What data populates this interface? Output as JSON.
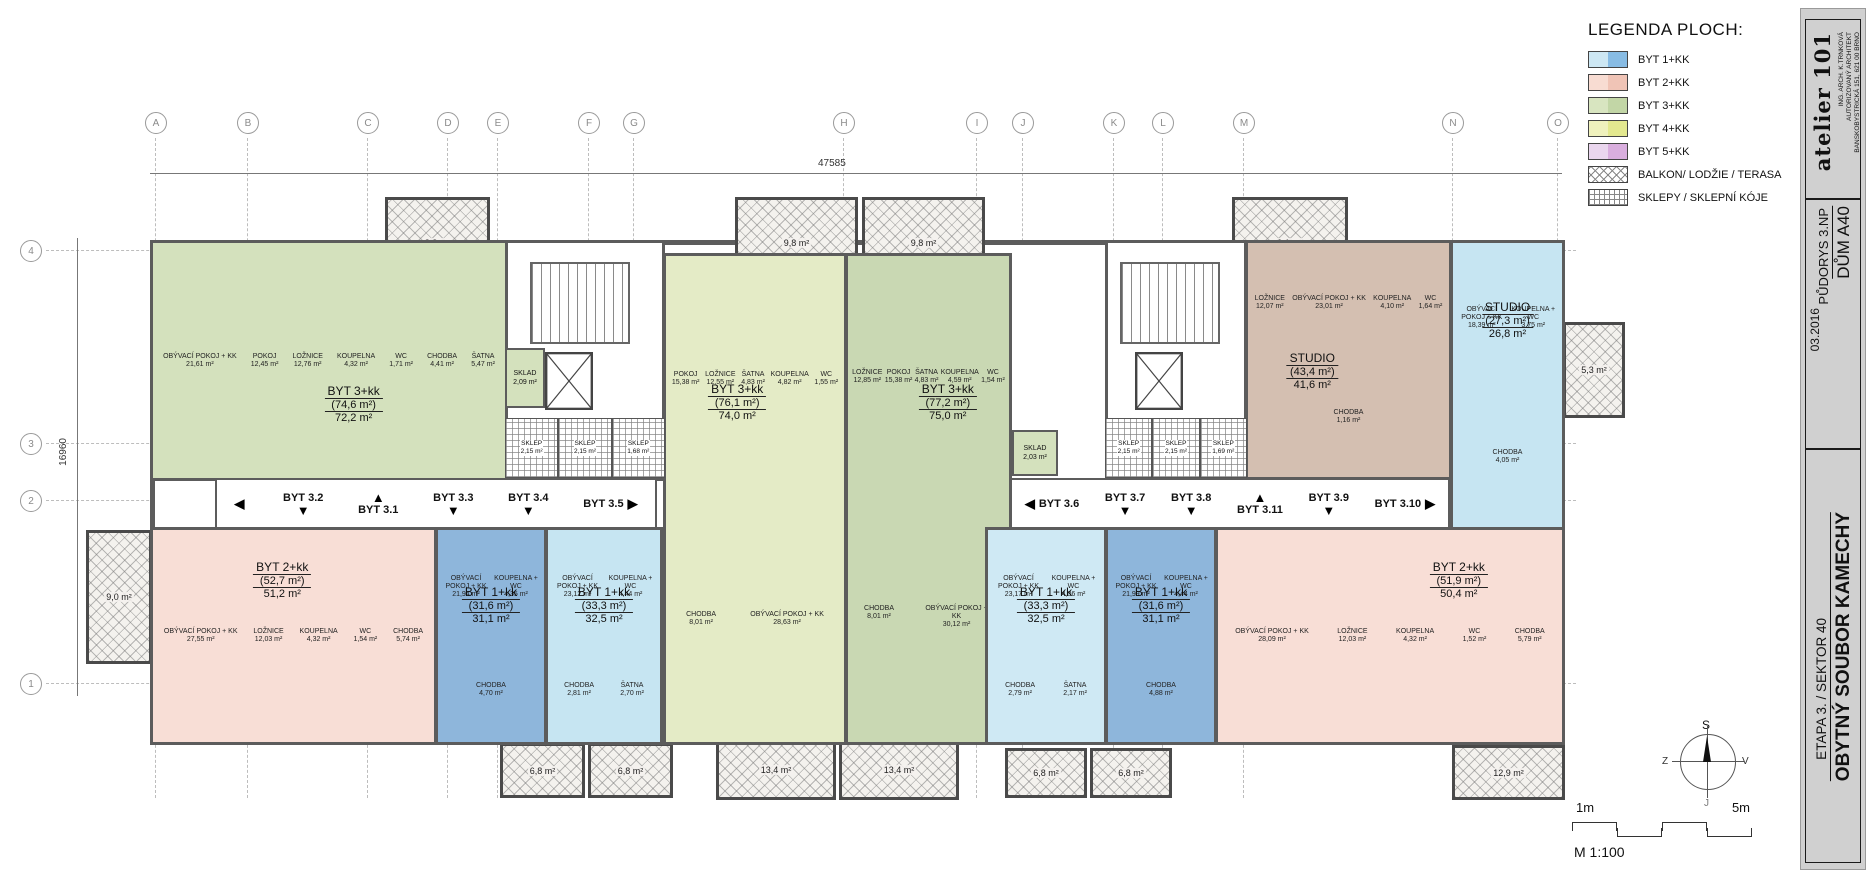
{
  "legend": {
    "title": "LEGENDA PLOCH:",
    "items": [
      {
        "label": "BYT 1+KK",
        "pattern": "duo",
        "c1": "#cde7f3",
        "c2": "#88bce4"
      },
      {
        "label": "BYT 2+KK",
        "pattern": "duo",
        "c1": "#f8dcd2",
        "c2": "#f0c4b6"
      },
      {
        "label": "BYT 3+KK",
        "pattern": "duo",
        "c1": "#d8e5c0",
        "c2": "#c2d6a6"
      },
      {
        "label": "BYT 4+KK",
        "pattern": "duo",
        "c1": "#eff1bd",
        "c2": "#e3e88f"
      },
      {
        "label": "BYT 5+KK",
        "pattern": "duo",
        "c1": "#ead6ee",
        "c2": "#d9aede"
      },
      {
        "label": "BALKON/ LODŽIE / TERASA",
        "pattern": "crosshatch"
      },
      {
        "label": "SKLEPY / SKLEPNÍ KÓJE",
        "pattern": "grid"
      }
    ]
  },
  "title_block": {
    "studio": "atelier 101",
    "architect": "ING. ARCH. K.TRNKOVÁ",
    "architect2": "AUTORIZOVANÝ ARCHITEKT",
    "address": "BANSKOBYSTRICKÁ 151, 621 00 BRNO",
    "building": "DŮM A40",
    "drawing": "PŮDORYS 3.NP",
    "date": "03.2016",
    "project": "OBYTNÝ SOUBOR KAMECHY",
    "stage": "ETAPA 3. / SEKTOR 40"
  },
  "grid": {
    "columns": [
      "A",
      "B",
      "C",
      "D",
      "E",
      "F",
      "G",
      "H",
      "I",
      "J",
      "K",
      "L",
      "M",
      "N",
      "O"
    ],
    "rows": [
      "4",
      "3",
      "2",
      "1"
    ],
    "dim_h": "47585",
    "dim_v": "16960"
  },
  "apartments": [
    {
      "type": "BYT 3+kk",
      "gross": "(74,6 m²)",
      "net": "72,2 m²",
      "fill": "#d4e1bd",
      "rooms": [
        {
          "name": "OBÝVACÍ POKOJ + KK",
          "area": "21,61 m²"
        },
        {
          "name": "POKOJ",
          "area": "12,45 m²"
        },
        {
          "name": "LOŽNICE",
          "area": "12,76 m²"
        },
        {
          "name": "KOUPELNA",
          "area": "4,32 m²"
        },
        {
          "name": "WC",
          "area": "1,71 m²"
        },
        {
          "name": "CHODBA",
          "area": "4,41 m²"
        },
        {
          "name": "ŠATNA",
          "area": "5,47 m²"
        }
      ]
    },
    {
      "type": "BYT 3+kk",
      "gross": "(76,1 m²)",
      "net": "74,0 m²",
      "fill": "#e4ebc6",
      "rooms": [
        {
          "name": "POKOJ",
          "area": "15,38 m²"
        },
        {
          "name": "LOŽNICE",
          "area": "12,55 m²"
        },
        {
          "name": "ŠATNA",
          "area": "4,83 m²"
        },
        {
          "name": "KOUPELNA",
          "area": "4,82 m²"
        },
        {
          "name": "WC",
          "area": "1,55 m²"
        },
        {
          "name": "CHODBA",
          "area": "8,01 m²"
        },
        {
          "name": "OBÝVACÍ POKOJ + KK",
          "area": "28,63 m²"
        }
      ]
    },
    {
      "type": "BYT 3+kk",
      "gross": "(77,2 m²)",
      "net": "75,0 m²",
      "fill": "#c9d8b3",
      "rooms": [
        {
          "name": "LOŽNICE",
          "area": "12,85 m²"
        },
        {
          "name": "POKOJ",
          "area": "15,38 m²"
        },
        {
          "name": "ŠATNA",
          "area": "4,83 m²"
        },
        {
          "name": "KOUPELNA",
          "area": "4,59 m²"
        },
        {
          "name": "WC",
          "area": "1,54 m²"
        },
        {
          "name": "CHODBA",
          "area": "8,01 m²"
        },
        {
          "name": "OBÝVACÍ POKOJ + KK",
          "area": "30,12 m²"
        }
      ]
    },
    {
      "type": "STUDIO",
      "gross": "(43,4 m²)",
      "net": "41,6 m²",
      "fill": "#d4bfb1",
      "rooms": [
        {
          "name": "LOŽNICE",
          "area": "12,07 m²"
        },
        {
          "name": "OBÝVACÍ POKOJ + KK",
          "area": "23,01 m²"
        },
        {
          "name": "KOUPELNA",
          "area": "4,10 m²"
        },
        {
          "name": "WC",
          "area": "1,64 m²"
        },
        {
          "name": "CHODBA",
          "area": "1,16 m²"
        }
      ]
    },
    {
      "type": "STUDIO",
      "gross": "(27,3 m²)",
      "net": "26,8 m²",
      "fill": "#c6e5f2",
      "rooms": [
        {
          "name": "OBÝVACÍ POKOJ + KK",
          "area": "18,39 m²"
        },
        {
          "name": "KOUPELNA + WC",
          "area": "3,75 m²"
        },
        {
          "name": "CHODBA",
          "area": "4,05 m²"
        }
      ]
    },
    {
      "type": "BYT 2+kk",
      "gross": "(52,7 m²)",
      "net": "51,2 m²",
      "fill": "#f8ded6",
      "rooms": [
        {
          "name": "OBÝVACÍ POKOJ + KK",
          "area": "27,55 m²"
        },
        {
          "name": "LOŽNICE",
          "area": "12,03 m²"
        },
        {
          "name": "KOUPELNA",
          "area": "4,32 m²"
        },
        {
          "name": "WC",
          "area": "1,54 m²"
        },
        {
          "name": "CHODBA",
          "area": "5,74 m²"
        }
      ]
    },
    {
      "type": "BYT 1+kk",
      "gross": "(31,6 m²)",
      "net": "31,1 m²",
      "fill": "#8eb6db",
      "rooms": [
        {
          "name": "OBÝVACÍ POKOJ + KK",
          "area": "21,94 m²"
        },
        {
          "name": "KOUPELNA + WC",
          "area": "4,35 m²"
        },
        {
          "name": "CHODBA",
          "area": "4,70 m²"
        }
      ]
    },
    {
      "type": "BYT 1+kk",
      "gross": "(33,3 m²)",
      "net": "32,5 m²",
      "fill": "#c6e5f2",
      "rooms": [
        {
          "name": "OBÝVACÍ POKOJ + KK",
          "area": "23,12 m²"
        },
        {
          "name": "KOUPELNA + WC",
          "area": "4,44 m²"
        },
        {
          "name": "CHODBA",
          "area": "2,81 m²"
        },
        {
          "name": "ŠATNA",
          "area": "2,70 m²"
        }
      ]
    },
    {
      "type": "BYT 1+kk",
      "gross": "(33,3 m²)",
      "net": "32,5 m²",
      "fill": "#cfe9f4",
      "rooms": [
        {
          "name": "OBÝVACÍ POKOJ + KK",
          "area": "23,17 m²"
        },
        {
          "name": "KOUPELNA + WC",
          "area": "4,36 m²"
        },
        {
          "name": "CHODBA",
          "area": "2,79 m²"
        },
        {
          "name": "ŠATNA",
          "area": "2,17 m²"
        }
      ]
    },
    {
      "type": "BYT 1+kk",
      "gross": "(31,6 m²)",
      "net": "31,1 m²",
      "fill": "#8eb6db",
      "rooms": [
        {
          "name": "OBÝVACÍ POKOJ + KK",
          "area": "21,99 m²"
        },
        {
          "name": "KOUPELNA + WC",
          "area": "4,44 m²"
        },
        {
          "name": "CHODBA",
          "area": "4,88 m²"
        }
      ]
    },
    {
      "type": "BYT 2+kk",
      "gross": "(51,9 m²)",
      "net": "50,4 m²",
      "fill": "#f8ded6",
      "rooms": [
        {
          "name": "OBÝVACÍ POKOJ + KK",
          "area": "28,09 m²"
        },
        {
          "name": "LOŽNICE",
          "area": "12,03 m²"
        },
        {
          "name": "KOUPELNA",
          "area": "4,32 m²"
        },
        {
          "name": "WC",
          "area": "1,52 m²"
        },
        {
          "name": "CHODBA",
          "area": "5,79 m²"
        }
      ]
    }
  ],
  "corridor": {
    "left": [
      {
        "label": "",
        "arrow": "◀"
      },
      {
        "label": "BYT 3.2",
        "arrow": "▼"
      },
      {
        "label": "BYT 3.1",
        "arrow": "▲"
      },
      {
        "label": "BYT 3.3",
        "arrow": "▼"
      },
      {
        "label": "BYT 3.4",
        "arrow": "▼"
      },
      {
        "label": "BYT 3.5",
        "arrow": "▶"
      }
    ],
    "right": [
      {
        "label": "BYT 3.6",
        "arrow": "◀"
      },
      {
        "label": "BYT 3.7",
        "arrow": "▼"
      },
      {
        "label": "BYT 3.8",
        "arrow": "▼"
      },
      {
        "label": "BYT 3.11",
        "arrow": "▲"
      },
      {
        "label": "BYT 3.9",
        "arrow": "▼"
      },
      {
        "label": "BYT 3.10",
        "arrow": "▶"
      }
    ]
  },
  "balconies": [
    {
      "area": "8,8 m²"
    },
    {
      "area": "9,8 m²"
    },
    {
      "area": "9,8 m²"
    },
    {
      "area": "9,1 m²"
    },
    {
      "area": "5,3 m²"
    },
    {
      "area": "9,0 m²"
    },
    {
      "area": "6,8 m²"
    },
    {
      "area": "6,8 m²"
    },
    {
      "area": "13,4 m²"
    },
    {
      "area": "13,4 m²"
    },
    {
      "area": "6,8 m²"
    },
    {
      "area": "6,8 m²"
    },
    {
      "area": "12,9 m²"
    }
  ],
  "storage": {
    "left": {
      "sklad": {
        "name": "SKLAD",
        "area": "2,09 m²"
      },
      "cells": [
        {
          "name": "SKLEP",
          "area": "2,15 m²"
        },
        {
          "name": "SKLEP",
          "area": "2,15 m²"
        },
        {
          "name": "SKLEP",
          "area": "1,68 m²"
        }
      ]
    },
    "right": {
      "sklad": {
        "name": "SKLAD",
        "area": "2,03 m²"
      },
      "cells": [
        {
          "name": "SKLEP",
          "area": "2,15 m²"
        },
        {
          "name": "SKLEP",
          "area": "2,15 m²"
        },
        {
          "name": "SKLEP",
          "area": "1,69 m²"
        }
      ]
    }
  },
  "compass": {
    "n": "S",
    "e": "V",
    "s": "J",
    "w": "Z"
  },
  "scale": {
    "left": "1m",
    "right": "5m",
    "text": "M 1:100"
  }
}
